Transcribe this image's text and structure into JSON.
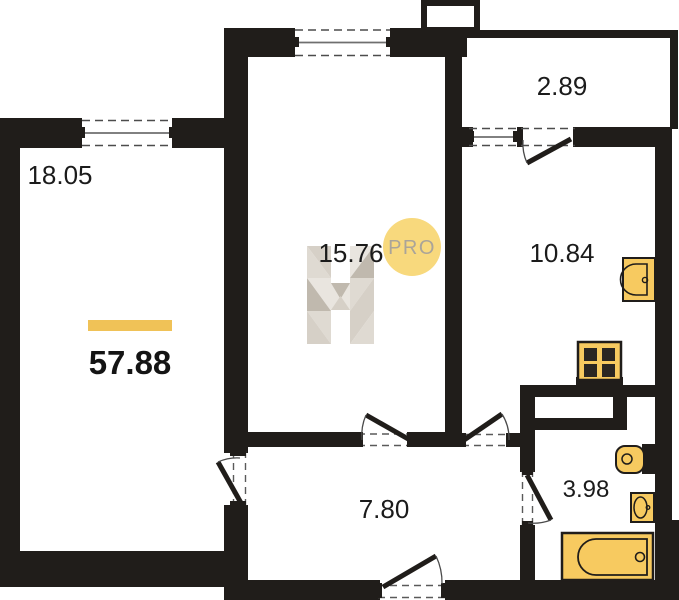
{
  "floorplan": {
    "total": {
      "area": "57.88"
    },
    "rooms": [
      {
        "id": "living-room",
        "area": "18.05"
      },
      {
        "id": "bedroom",
        "area": "15.76"
      },
      {
        "id": "balcony",
        "area": "2.89"
      },
      {
        "id": "kitchen",
        "area": "10.84"
      },
      {
        "id": "hallway",
        "area": "7.80"
      },
      {
        "id": "bathroom",
        "area": "3.98"
      }
    ],
    "watermark": {
      "badge": "PRO"
    },
    "colors": {
      "wall": "#201d1a",
      "fixture": "#f7ca60",
      "accent_bar": "#f0c257",
      "badge_fill": "#f8d97d",
      "badge_text": "#aaa499"
    },
    "fixtures": [
      "stove",
      "kitchen-sink",
      "toilet",
      "washbasin",
      "bathtub"
    ]
  }
}
